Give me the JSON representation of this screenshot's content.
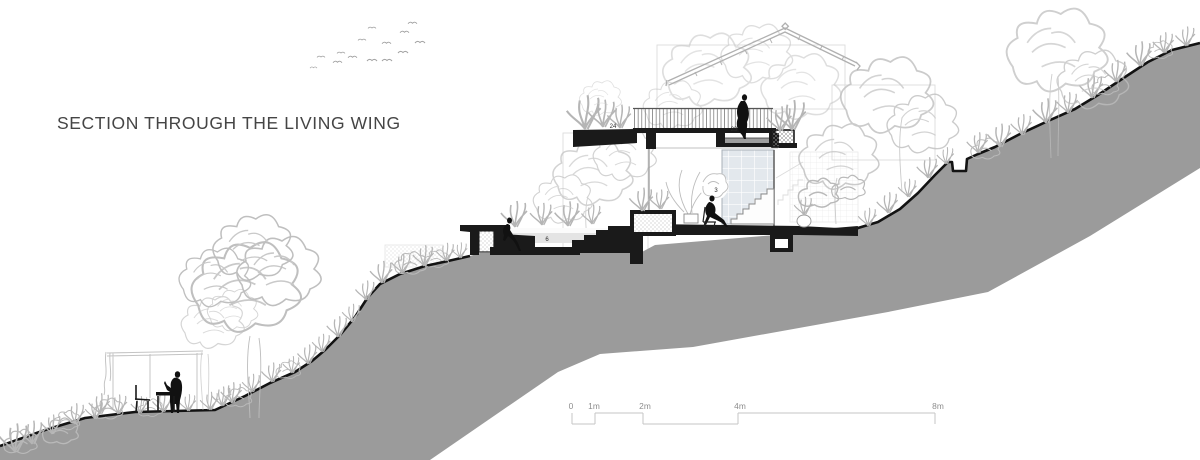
{
  "title": "SECTION THROUGH THE LIVING WING",
  "annotations": {
    "terrace_label": "24",
    "roof_deck_label": "23",
    "living_room_label": "3",
    "sunken_lounge_label": "6"
  },
  "scale_bar": {
    "labels": [
      "0",
      "1m",
      "2m",
      "4m",
      "8m"
    ]
  },
  "colors": {
    "terrain_fill": "#9b9b9b",
    "terrain_outline": "#131313",
    "section_cut": "#1a1a1a",
    "line_art": "#bdbdbd",
    "glazing_fill": "#e3e8ed",
    "title_text": "#454545",
    "scale_text": "#8d8d8d"
  }
}
